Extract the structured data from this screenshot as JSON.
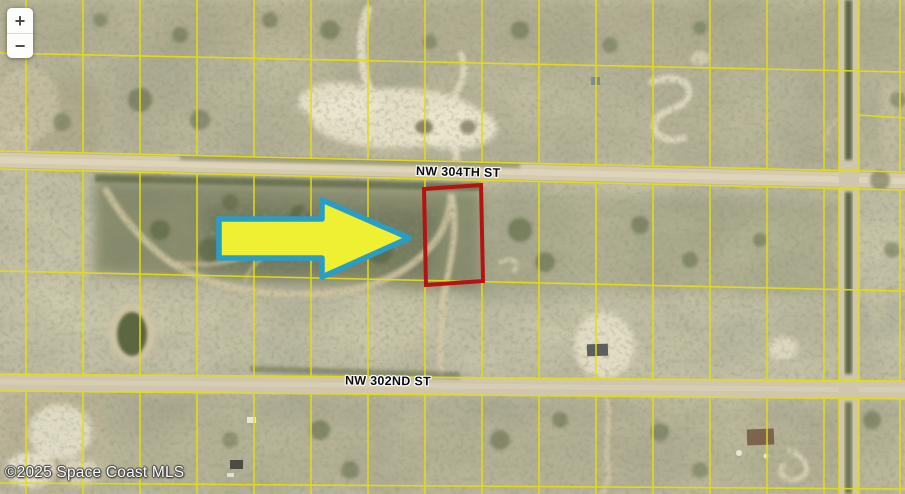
{
  "map": {
    "attribution": "©2025 Space Coast MLS",
    "streets": {
      "street_304": "NW 304TH ST",
      "street_302": "NW 302ND ST"
    },
    "zoom_control": {
      "zoom_in": "+",
      "zoom_out": "−"
    },
    "colors": {
      "parcel_line": "#e3df10",
      "highlight_outline": "#b51313",
      "arrow_fill": "#f0f033",
      "arrow_stroke": "#2a9dc6"
    }
  }
}
